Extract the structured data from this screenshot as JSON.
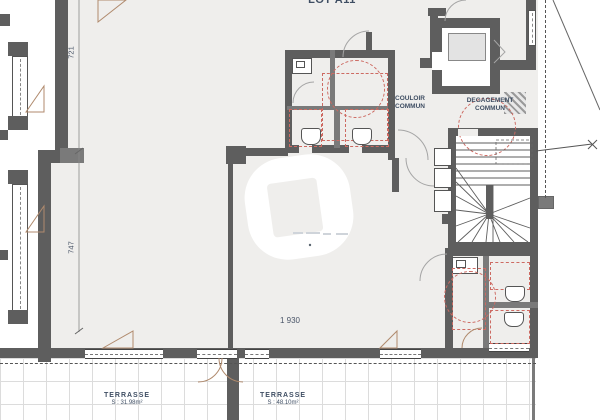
{
  "plan": {
    "lot_label": "LOT A11",
    "rooms": {
      "couloir": {
        "line1": "COULOIR",
        "line2": "COMMUN"
      },
      "degagement": {
        "line1": "DEGAGEMENT",
        "line2": "COMMUN"
      }
    },
    "dimensions": {
      "vertical_top": "721",
      "vertical_bottom": "747",
      "horizontal": "1 930"
    },
    "terraces": [
      {
        "name": "TERRASSE",
        "area": "S : 31.98m²"
      },
      {
        "name": "TERRASSE",
        "area": "S : 48.10m²"
      }
    ],
    "colors": {
      "wall": "#5e5e5e",
      "floor": "#efeeec",
      "fixture_red": "#cd6a62",
      "door_swing": "#b08a6d",
      "label_text": "#3f4e63",
      "terrace_grid": "#dcdcdc"
    }
  }
}
